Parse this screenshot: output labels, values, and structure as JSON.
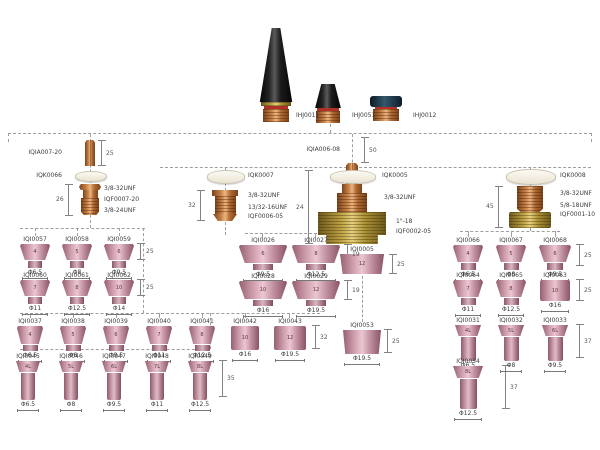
{
  "colors": {
    "ceramic_pink": "#cf9fae",
    "copper": "#c9854b",
    "brass": "#bfa347",
    "cap_black": "#111111",
    "oring_red": "#b03028"
  },
  "back_caps": {
    "items": [
      {
        "id": "IHJ0011"
      },
      {
        "id": "IHJ0051"
      },
      {
        "id": "IHJ0012"
      }
    ]
  },
  "branch1": {
    "collet_id": "IQIA007-20",
    "collet_dim": "25",
    "gasket_id": "IQK0066",
    "body_thread_top": "3/8-32UNF",
    "body_id": "IQF0007-20",
    "body_thread_bottom": "3/8-24UNF",
    "body_dim": "26"
  },
  "branch2": {
    "gasket_id": "IQK0007",
    "body_thread_top": "3/8-32UNF",
    "body_thread_bottom": "13/32-16UNF",
    "body_id": "IQF0006-05",
    "body_dim": "32"
  },
  "branch3": {
    "collet_id": "IQIA006-08",
    "collet_dim": "50",
    "gasket_id": "IQK0005",
    "body_thread_top": "3/8-32UNF",
    "body_thread_bottom": "1\"-18",
    "body_id": "IQF0002-05",
    "body_dim": "24"
  },
  "branch4": {
    "gasket_id": "IQK0008",
    "body_thread_top": "3/8-32UNF",
    "body_thread_bottom": "5/8-18UNF",
    "body_id": "IQF0001-10",
    "body_dim": "45"
  },
  "left_group": {
    "row1": [
      {
        "id": "IQI0057",
        "mark": "4",
        "dia": "Φ6.5"
      },
      {
        "id": "IQI0058",
        "mark": "5",
        "dia": "Φ8"
      },
      {
        "id": "IQI0059",
        "mark": "6",
        "dia": "Φ9.5"
      }
    ],
    "row1_dim": "25",
    "row2": [
      {
        "id": "IQI0060",
        "mark": "7",
        "dia": "Φ11"
      },
      {
        "id": "IQI0061",
        "mark": "8",
        "dia": "Φ12.5"
      },
      {
        "id": "IQI0062",
        "mark": "10",
        "dia": "Φ14"
      }
    ],
    "row2_dim": "25"
  },
  "mid_group": {
    "row1": [
      {
        "id": "IQI0026",
        "mark": "6",
        "dia": "Φ9.5"
      },
      {
        "id": "IQI0027",
        "mark": "8",
        "dia": "Φ12.5"
      }
    ],
    "row1_dim": "19",
    "row2": [
      {
        "id": "IQI0028",
        "mark": "10",
        "dia": "Φ16"
      },
      {
        "id": "IQI0029",
        "mark": "12",
        "dia": "Φ19.5"
      }
    ],
    "row2_dim": "19"
  },
  "single_cup": {
    "id": "IQI0005",
    "mark": "12",
    "dim": "25"
  },
  "big_cup": {
    "id": "IQI0053",
    "dia": "Φ19.5",
    "dim": "25"
  },
  "row7": {
    "items": [
      {
        "id": "IQI0037",
        "mark": "4",
        "dia": "Φ6.5"
      },
      {
        "id": "IQI0038",
        "mark": "5",
        "dia": "Φ8"
      },
      {
        "id": "IQI0039",
        "mark": "6",
        "dia": "Φ9.5"
      },
      {
        "id": "IQI0040",
        "mark": "7",
        "dia": "Φ11"
      },
      {
        "id": "IQI0041",
        "mark": "8",
        "dia": "Φ12.5"
      },
      {
        "id": "IQI0042",
        "mark": "10",
        "dia": "Φ16"
      },
      {
        "id": "IQI0043",
        "mark": "12",
        "dia": "Φ19.5"
      }
    ],
    "dim": "32"
  },
  "long_row": {
    "items": [
      {
        "id": "IQI0045",
        "mark": "4L",
        "dia": "Φ6.5"
      },
      {
        "id": "IQI0046",
        "mark": "5L",
        "dia": "Φ8"
      },
      {
        "id": "IQI0047",
        "mark": "6L",
        "dia": "Φ9.5"
      },
      {
        "id": "IQI0048",
        "mark": "7L",
        "dia": "Φ11"
      },
      {
        "id": "IQI0049",
        "mark": "8L",
        "dia": "Φ12.5"
      }
    ],
    "dim": "35"
  },
  "right_group": {
    "row1": [
      {
        "id": "IQI0066",
        "mark": "4",
        "dia": "Φ6.5"
      },
      {
        "id": "IQI0067",
        "mark": "5",
        "dia": "Φ8"
      },
      {
        "id": "IQI0068",
        "mark": "6",
        "dia": "Φ9.5"
      }
    ],
    "row1_dim": "25",
    "row2": [
      {
        "id": "IQI0064",
        "mark": "7",
        "dia": "Φ11"
      },
      {
        "id": "IQI0065",
        "mark": "8",
        "dia": "Φ12.5"
      },
      {
        "id": "IQI0063",
        "mark": "10",
        "dia": "Φ16"
      }
    ],
    "row2_dim": "25",
    "row3": [
      {
        "id": "IQI0031",
        "mark": "4L",
        "dia": "Φ6.5"
      },
      {
        "id": "IQI0032",
        "mark": "5L",
        "dia": "Φ8"
      },
      {
        "id": "IQI0033",
        "mark": "6L",
        "dia": "Φ9.5"
      }
    ],
    "row3_dim": "37",
    "row4": [
      {
        "id": "IQI0034",
        "mark": "8L",
        "dia": "Φ12.5"
      }
    ],
    "row4_dim": "37"
  }
}
